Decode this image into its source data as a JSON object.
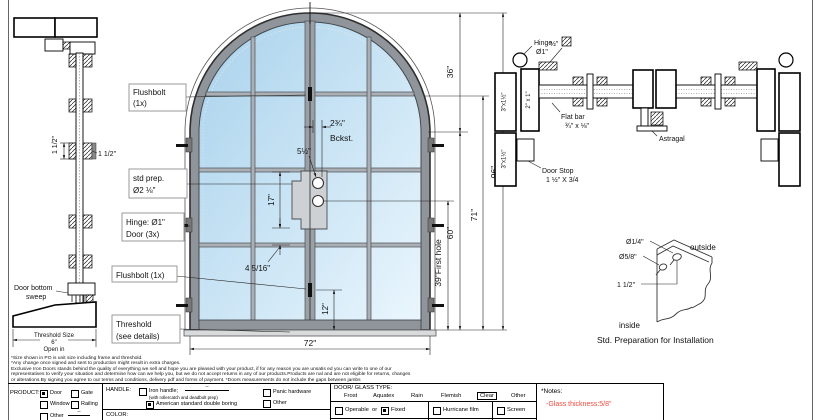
{
  "sheet": {
    "colors": {
      "glass_top": "#a9d2ec",
      "glass_bottom": "#eaf6fd",
      "frame": "#8f959a",
      "note_red": "#f04a3e"
    }
  },
  "left_section": {
    "dim_vertical": "1 1/2\"",
    "dim_horizontal": "1 1/2\"",
    "sweep_line1": "Door bottom",
    "sweep_line2": "sweep",
    "threshold_line1": "Threshold Size",
    "threshold_line2": "6\"",
    "threshold_line3": "Open in"
  },
  "door": {
    "callouts": {
      "flushbolt_top1": "Flushbolt",
      "flushbolt_top2": "(1x)",
      "std_prep1": "std prep.",
      "std_prep2": "Ø2 ⅛\"",
      "hinge1": "Hinge: Ø1\"",
      "hinge2": "Door (3x)",
      "flushbolt_bottom": "Flushbolt (1x)",
      "threshold1": "Threshold",
      "threshold2": "(see details)"
    },
    "dims": {
      "backset": "2¾\"",
      "backset_word": "Bckst.",
      "lock_height": "5½\"",
      "plate": "17\"",
      "below_plate": "4 5/16\"",
      "bottom": "12\"",
      "width": "72\"",
      "arch_height": "36\"",
      "total_height": "96\"",
      "handle_height": "71\"",
      "spring_height": "60\"",
      "first_hole": "39\"First hole"
    }
  },
  "plan": {
    "hinge1": "Hinge",
    "hinge2": "Ø1\"",
    "square_bar": "½\"",
    "jamb_top": "3\"x1½\"",
    "jamb_bottom": "3\"x1½\"",
    "stile": "2\" x 1\"",
    "flat_bar1": "Flat bar",
    "flat_bar2": "¾\" x ⅛\"",
    "door_stop1": "Door Stop",
    "door_stop2": "1 ½\" X 3/4",
    "astragal": "Astragal"
  },
  "std_prep": {
    "hole_small": "Ø1/4\"",
    "hole_big": "Ø5/8\"",
    "offset": "1 1/2\"",
    "outside": "outside",
    "inside": "inside",
    "caption": "Std. Preparation for Installation"
  },
  "disclaimer": {
    "lines": [
      "*Size shown in PO is unit size including frame and threshold.",
      "*Any change once signed and sent to production might result in extra charges.",
      "Exclusive Iron Doors stands behind the quality of everything we sell and hope you are pleased with your product, if for any reason you are unsatis  ed you can write to one of our",
      "representatives to verify your situation and determine how can we help you, but we do not accept returns in any of our products.Products are   nal and are not eligible for returns, changes",
      "or alterations.By signing you agree to our terms and conditions, delivery pdf and forms of payment. *Doors measurements do not include the gaps between jambs"
    ]
  },
  "form": {
    "product": {
      "label": "PRODUCT:",
      "door": "Door",
      "gate": "Gate",
      "window": "Window",
      "railing": "Railing",
      "other": "Other",
      "other_suffix": "--"
    },
    "handle": {
      "label": "HANDLE:",
      "iron": "Iron handle;",
      "iron_suffix": "--",
      "iron_note": "(with rollercatch and deadbolt prep)",
      "american": "American standard double boring",
      "panic": "Panic hardware",
      "other": "Other",
      "color": "COLOR:"
    },
    "glass": {
      "label": "DOOR/ GLASS TYPE:",
      "frost": "Frost",
      "aquatex": "Aquatex",
      "rain": "Rain",
      "flemish": "Flemish",
      "clear": "Clear",
      "other": "Other",
      "operable": "Operable",
      "or": "or",
      "fixed": "Fixed",
      "hurricane": "Hurricane film",
      "screen": "Screen"
    },
    "notes": {
      "label": "*Notes:",
      "note": "-Glass thickness:5/8\""
    }
  }
}
